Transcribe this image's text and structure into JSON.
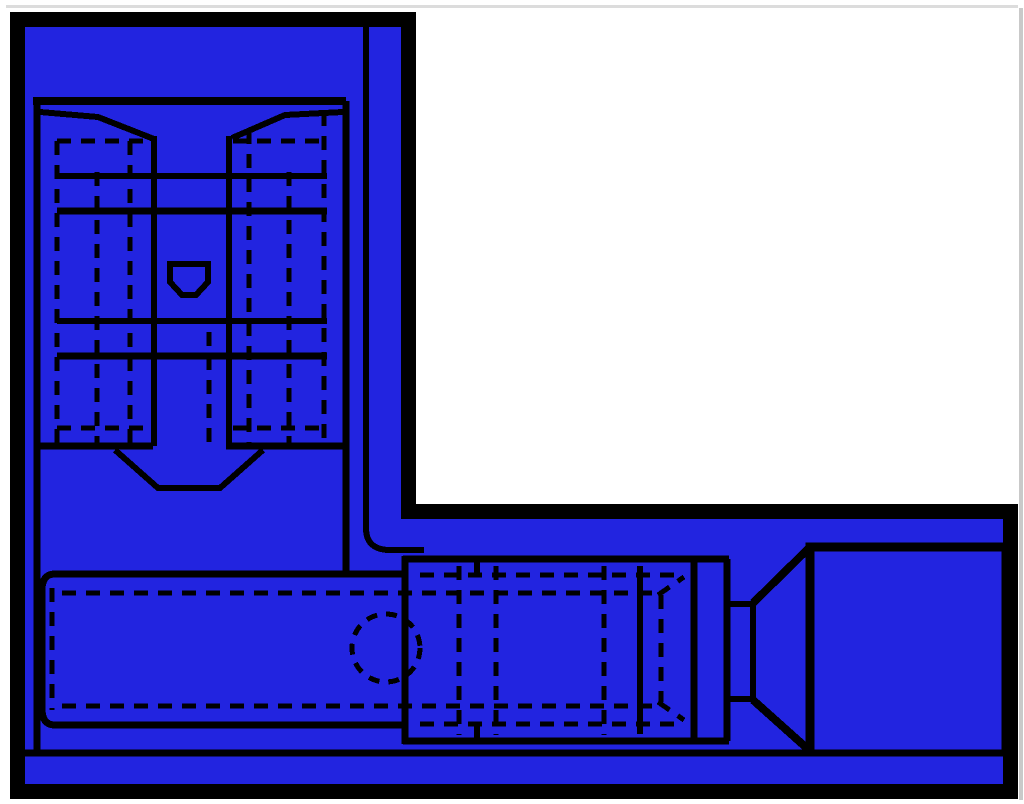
{
  "canvas": {
    "width": 1024,
    "height": 804,
    "background": "#ffffff"
  },
  "colors": {
    "panel_fill": "#2224E0",
    "line": "#000000",
    "edge_artifact": "#cccccc"
  },
  "artifacts": [
    {
      "x": 6,
      "y": 5,
      "w": 1012,
      "h": 3,
      "fill": "#dcdcdc"
    },
    {
      "x": 1019,
      "y": 8,
      "w": 4,
      "h": 792,
      "fill": "#c9c9c9"
    }
  ],
  "panel": {
    "name": "blue-l-shaped-sheet",
    "outline_path": "M17.5 19.5 H408.5 V511.5 H1010.5 V791.5 H17.5 Z",
    "border_width": 15
  },
  "drawing": {
    "alt": "Two-view engineering drawing of an insulated quick-disconnect crimp terminal",
    "dash_pattern": "14 10",
    "solid_paths": [
      {
        "part": "inner-frame-line",
        "d": "M366 26 V528 Q366 550 390 550 H424",
        "w": 6
      },
      {
        "part": "topview-box-top",
        "d": "M33 101 H346",
        "w": 8
      },
      {
        "part": "topview-box-left-extended",
        "d": "M37 101 V753",
        "w": 7
      },
      {
        "part": "topview-box-right-extended",
        "d": "M346 101 V577",
        "w": 7
      },
      {
        "part": "topview-box-bottom",
        "d": "M37 446 H153 M226 446 H346",
        "w": 7
      },
      {
        "part": "topview-funnel-left",
        "d": "M40 112 L98 117 L154 139",
        "w": 6
      },
      {
        "part": "topview-funnel-right",
        "d": "M343 112 L285 115 L232 138",
        "w": 6
      },
      {
        "part": "topview-channel-left",
        "d": "M154 136 V446",
        "w": 6
      },
      {
        "part": "topview-channel-right",
        "d": "M229 136 V446",
        "w": 6
      },
      {
        "part": "topview-band-1",
        "d": "M57 176 H327",
        "w": 6
      },
      {
        "part": "topview-band-2",
        "d": "M57 211 H327",
        "w": 7
      },
      {
        "part": "topview-band-3",
        "d": "M57 321 H327",
        "w": 6
      },
      {
        "part": "topview-band-4",
        "d": "M57 356 H327",
        "w": 7
      },
      {
        "part": "topview-vee-cut",
        "d": "M115 450 L158 488 H220 L263 450",
        "w": 6
      },
      {
        "part": "topview-shield-detail",
        "d": "M170 264 H208 V282 L196 295 H182 L170 282 Z",
        "w": 6
      },
      {
        "part": "sideview-sleeve-outline",
        "d": "M406 574 H55 Q42 574 42 590 V709 Q42 725 55 725 H406",
        "w": 7
      },
      {
        "part": "sideview-crimp-top",
        "d": "M403 559 H729",
        "w": 7
      },
      {
        "part": "sideview-crimp-bottom",
        "d": "M403 741 H729",
        "w": 7
      },
      {
        "part": "sideview-crimp-left-edge",
        "d": "M405 556 V744",
        "w": 7
      },
      {
        "part": "sideview-crimp-mid-edge",
        "d": "M640 566 V734",
        "w": 6
      },
      {
        "part": "sideview-stop-flange",
        "d": "M694 559 V741 M727 559 V741",
        "w": 7
      },
      {
        "part": "sideview-neck",
        "d": "M727 604 H753 M727 699 H753 M753 601 V702",
        "w": 6
      },
      {
        "part": "sideview-funnel-upper",
        "d": "M753 603 L810 547",
        "w": 8
      },
      {
        "part": "sideview-funnel-lower",
        "d": "M753 700 L810 751",
        "w": 8
      },
      {
        "part": "sideview-tongue-square",
        "d": "M810 753 V547 H1006 V753",
        "w": 9
      },
      {
        "part": "ground-baseline",
        "d": "M24 753 H1008",
        "w": 7
      },
      {
        "part": "sideview-step-jogs",
        "d": "M477 560 V576 M477 724 V740",
        "w": 6
      }
    ],
    "dashed_paths": [
      {
        "part": "wing-top-hidden-left",
        "d": "M57 141 H150",
        "w": 5
      },
      {
        "part": "wing-top-hidden-right",
        "d": "M233 141 H325",
        "w": 5
      },
      {
        "part": "wing-bottom-hidden-left",
        "d": "M57 428 H150",
        "w": 5
      },
      {
        "part": "wing-bottom-hidden-right",
        "d": "M233 428 H325",
        "w": 5
      },
      {
        "part": "wing-hidden-v1",
        "d": "M57 141 V443",
        "w": 5
      },
      {
        "part": "wing-hidden-v2",
        "d": "M97 172 V443",
        "w": 5
      },
      {
        "part": "wing-hidden-v3",
        "d": "M130 141 V443",
        "w": 5
      },
      {
        "part": "wing-hidden-v4",
        "d": "M249 130 V443",
        "w": 5
      },
      {
        "part": "wing-hidden-v5",
        "d": "M289 172 V443",
        "w": 5
      },
      {
        "part": "wing-hidden-v6",
        "d": "M324 112 V443",
        "w": 5
      },
      {
        "part": "channel-hidden-edge",
        "d": "M209 332 V443",
        "w": 5
      },
      {
        "part": "sleeve-hidden-left",
        "d": "M52 588 V710",
        "w": 5
      },
      {
        "part": "bore-hidden-top",
        "d": "M62 593 H660",
        "w": 5
      },
      {
        "part": "bore-hidden-bottom",
        "d": "M62 706 H660",
        "w": 5
      },
      {
        "part": "sleeve-hidden-top-cont",
        "d": "M420 575 H680",
        "w": 5
      },
      {
        "part": "sleeve-hidden-bottom-cont",
        "d": "M420 724 H680",
        "w": 5
      },
      {
        "part": "crimp-hidden-v1",
        "d": "M459 566 V735",
        "w": 5
      },
      {
        "part": "crimp-hidden-v2",
        "d": "M496 566 V735",
        "w": 5
      },
      {
        "part": "crimp-hidden-v3",
        "d": "M604 566 V735",
        "w": 5
      },
      {
        "part": "crimp-hidden-v4",
        "d": "M661 595 V702",
        "w": 5
      },
      {
        "part": "crimp-chamfer-top",
        "d": "M658 595 L684 577",
        "w": 5
      },
      {
        "part": "crimp-chamfer-bottom",
        "d": "M658 702 L684 720",
        "w": 5
      }
    ],
    "dashed_circles": [
      {
        "part": "wire-hole-hidden-circle",
        "cx": 386,
        "cy": 648,
        "r": 34,
        "w": 5,
        "dash": "11 9"
      }
    ]
  }
}
